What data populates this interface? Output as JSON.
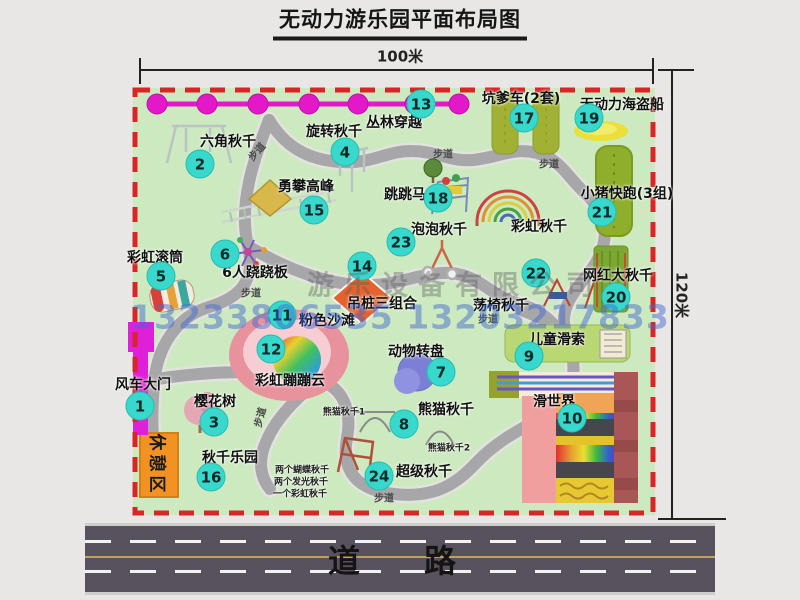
{
  "title": "无动力游乐园平面布局图",
  "dimensions": {
    "width_label": "100米",
    "height_label": "120米"
  },
  "road_label": "道　路",
  "watermark": {
    "company": "游乐设备有限公司",
    "phone": "13233806535 13203217833"
  },
  "rest_area_label": "休憩区",
  "walkway_text": "步道",
  "colors": {
    "map_bg": "#cde9c0",
    "border_red": "#d92525",
    "badge_cyan": "#38d8cd",
    "chain_magenta": "#e318c8",
    "road_gray": "#57525e",
    "rest_orange": "#f29222"
  },
  "attractions": [
    {
      "num": "1",
      "label": "风车大门",
      "lx": 143,
      "ly": 384,
      "bx": 140,
      "by": 406
    },
    {
      "num": "2",
      "label": "六角秋千",
      "lx": 228,
      "ly": 141,
      "bx": 200,
      "by": 164
    },
    {
      "num": "3",
      "label": "樱花树",
      "lx": 215,
      "ly": 401,
      "bx": 214,
      "by": 422
    },
    {
      "num": "4",
      "label": "旋转秋千",
      "lx": 334,
      "ly": 131,
      "bx": 345,
      "by": 152
    },
    {
      "num": "5",
      "label": "彩虹滚筒",
      "lx": 155,
      "ly": 257,
      "bx": 161,
      "by": 276
    },
    {
      "num": "6",
      "label": "6人跷跷板",
      "lx": 255,
      "ly": 272,
      "bx": 225,
      "by": 254
    },
    {
      "num": "7",
      "label": "动物转盘",
      "lx": 416,
      "ly": 351,
      "bx": 441,
      "by": 372
    },
    {
      "num": "8",
      "label": "熊猫秋千",
      "lx": 446,
      "ly": 409,
      "bx": 404,
      "by": 424
    },
    {
      "num": "9",
      "label": "儿童滑索",
      "lx": 557,
      "ly": 339,
      "bx": 529,
      "by": 356
    },
    {
      "num": "10",
      "label": "滑世界",
      "lx": 554,
      "ly": 401,
      "bx": 572,
      "by": 418
    },
    {
      "num": "11",
      "label": "粉色沙滩",
      "lx": 327,
      "ly": 320,
      "bx": 282,
      "by": 315
    },
    {
      "num": "12",
      "label": "彩虹蹦蹦云",
      "lx": 290,
      "ly": 380,
      "bx": 271,
      "by": 349
    },
    {
      "num": "13",
      "label": "丛林穿越",
      "lx": 394,
      "ly": 122,
      "bx": 421,
      "by": 104
    },
    {
      "num": "14",
      "label": "吊桩三组合",
      "lx": 382,
      "ly": 303,
      "bx": 362,
      "by": 266
    },
    {
      "num": "15",
      "label": "勇攀高峰",
      "lx": 306,
      "ly": 186,
      "bx": 314,
      "by": 210
    },
    {
      "num": "16",
      "label": "秋千乐园",
      "lx": 230,
      "ly": 457,
      "bx": 211,
      "by": 477
    },
    {
      "num": "17",
      "label": "坑爹车(2套)",
      "lx": 521,
      "ly": 98,
      "bx": 524,
      "by": 118
    },
    {
      "num": "18",
      "label": "跳跳马",
      "lx": 405,
      "ly": 194,
      "bx": 438,
      "by": 198
    },
    {
      "num": "19",
      "label": "无动力海盗船",
      "lx": 622,
      "ly": 104,
      "bx": 589,
      "by": 118
    },
    {
      "num": "20",
      "label": "网红大秋千",
      "lx": 618,
      "ly": 275,
      "bx": 616,
      "by": 297
    },
    {
      "num": "21",
      "label": "小猪快跑(3组)",
      "lx": 627,
      "ly": 193,
      "bx": 602,
      "by": 212
    },
    {
      "num": "22",
      "label": "荡椅秋千",
      "lx": 501,
      "ly": 305,
      "bx": 536,
      "by": 273
    },
    {
      "num": "23",
      "label": "泡泡秋千",
      "lx": 439,
      "ly": 229,
      "bx": 401,
      "by": 242
    },
    {
      "num": "24",
      "label": "超级秋千",
      "lx": 424,
      "ly": 471,
      "bx": 379,
      "by": 476
    }
  ],
  "extra_labels": [
    {
      "text": "彩虹秋千",
      "x": 539,
      "y": 226,
      "cls": ""
    },
    {
      "text": "熊猫秋千1",
      "x": 344,
      "y": 411,
      "cls": "tiny"
    },
    {
      "text": "熊猫秋千2",
      "x": 449,
      "y": 447,
      "cls": "tiny"
    },
    {
      "text": "两个蝴蝶秋千",
      "x": 302,
      "y": 469,
      "cls": "tiny"
    },
    {
      "text": "两个发光秋千",
      "x": 301,
      "y": 481,
      "cls": "tiny"
    },
    {
      "text": "一个彩虹秋千",
      "x": 300,
      "y": 493,
      "cls": "tiny"
    }
  ],
  "walkway_positions": [
    {
      "x": 256,
      "y": 151,
      "r": -48
    },
    {
      "x": 443,
      "y": 153,
      "r": 0
    },
    {
      "x": 549,
      "y": 163,
      "r": 0
    },
    {
      "x": 251,
      "y": 292,
      "r": 0
    },
    {
      "x": 488,
      "y": 318,
      "r": 0
    },
    {
      "x": 259,
      "y": 417,
      "r": -75
    },
    {
      "x": 384,
      "y": 497,
      "r": 0
    }
  ]
}
